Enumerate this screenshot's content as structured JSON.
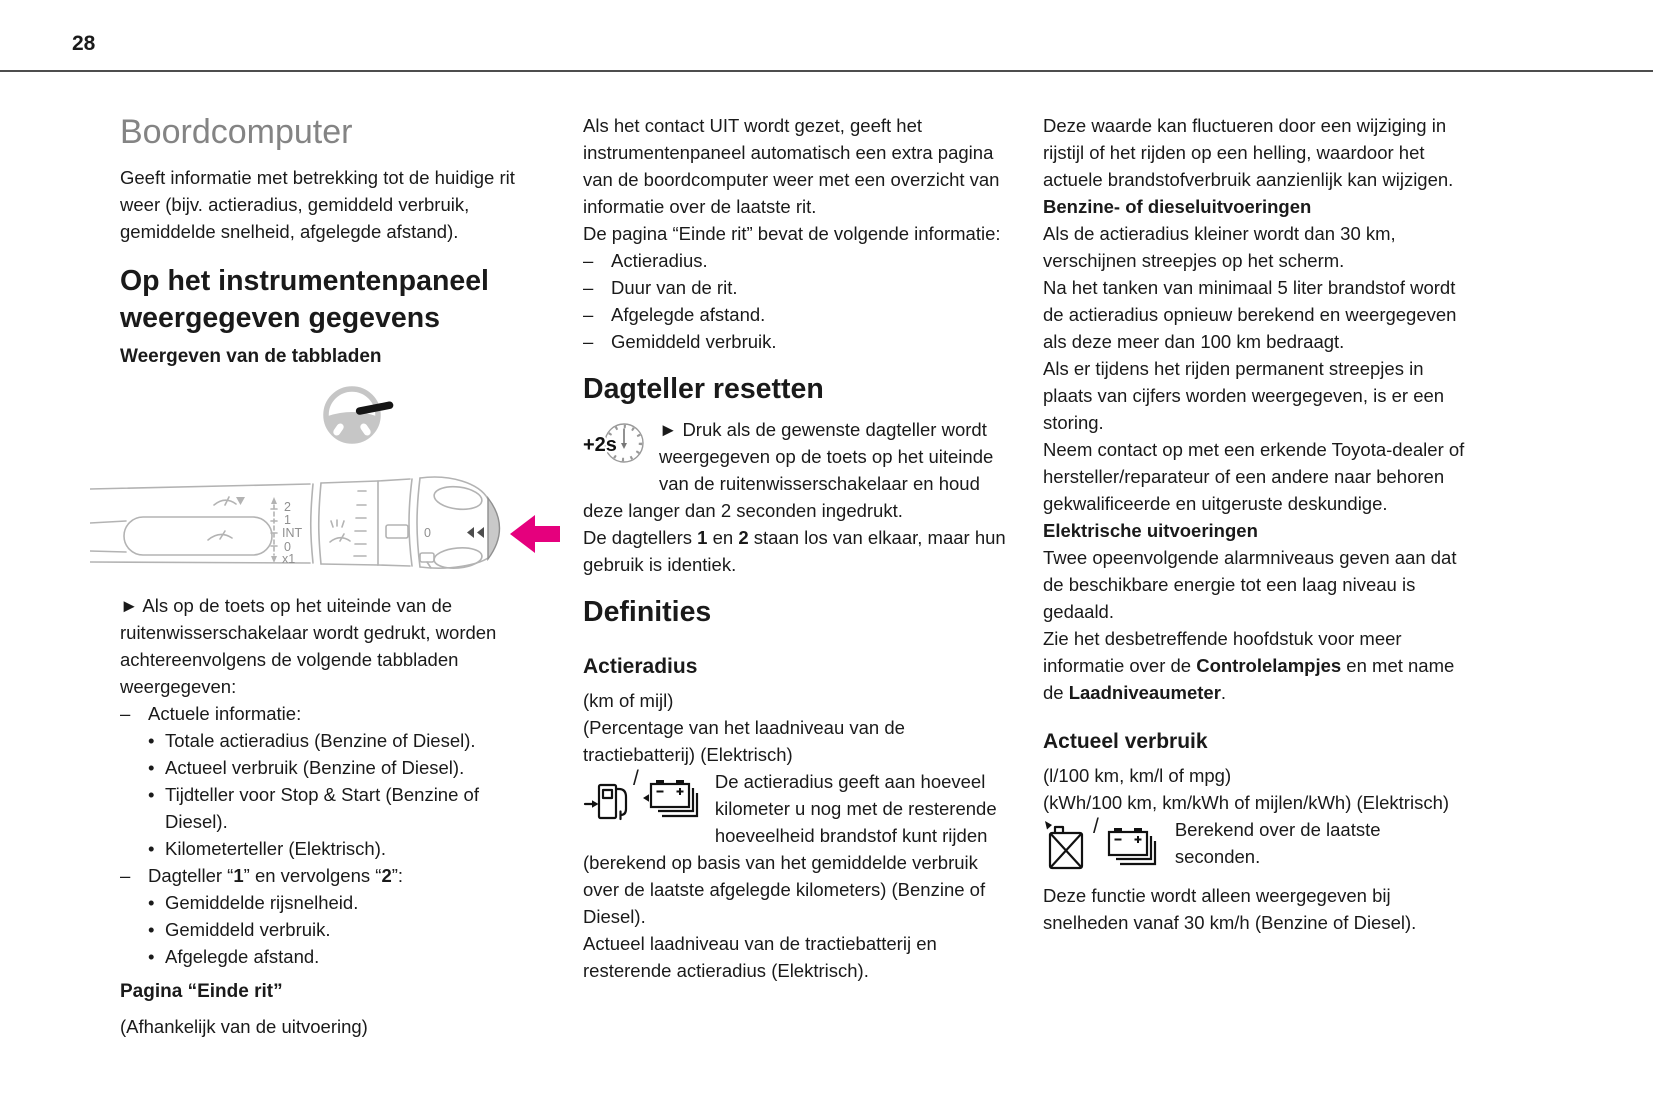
{
  "page": {
    "number": "28"
  },
  "colors": {
    "accent_arrow": "#e5007d",
    "title_gray": "#848484",
    "body_text": "#1a1a1a",
    "illustration_stroke": "#b3b3b3"
  },
  "col1": {
    "title": "Boordcomputer",
    "intro": "Geeft informatie met betrekking tot de huidige rit weer (bijv. actieradius, gemiddeld verbruik, gemiddelde snelheid, afgelegde afstand).",
    "h2": "Op het instrumentenpaneel weergegeven gegevens",
    "h3": "Weergeven van de tabbladen",
    "stalk_labels": {
      "speed2": "2",
      "speed1": "1",
      "int": "INT",
      "off": "0",
      "x1": "x1",
      "ring_zero": "0"
    },
    "arrow_note": "► Als op de toets op het uiteinde van de ruitenwisserschakelaar wordt gedrukt, worden achtereenvolgens de volgende tabbladen weergegeven:",
    "list": {
      "dash": "–",
      "bullet": "•",
      "item1": "Actuele informatie:",
      "sub1": [
        "Totale actieradius (Benzine of Diesel).",
        "Actueel verbruik (Benzine of Diesel).",
        "Tijdteller voor Stop & Start (Benzine of Diesel).",
        "Kilometerteller (Elektrisch)."
      ],
      "item2": {
        "a": "Dagteller “",
        "b": "1",
        "c": "” en vervolgens “",
        "d": "2",
        "e": "”:"
      },
      "sub2": [
        "Gemiddelde rijsnelheid.",
        "Gemiddeld verbruik.",
        "Afgelegde afstand."
      ]
    },
    "einde_rit_heading": "Pagina “Einde rit”",
    "einde_rit_note": "(Afhankelijk van de uitvoering)"
  },
  "col2": {
    "para1": "Als het contact UIT wordt gezet, geeft het instrumentenpaneel automatisch een extra pagina van de boordcomputer weer met een overzicht van informatie over de laatste rit.",
    "para2": "De pagina “Einde rit” bevat de volgende informatie:",
    "dash": "–",
    "dash_items": [
      "Actieradius.",
      "Duur van de rit.",
      "Afgelegde afstand.",
      "Gemiddeld verbruik."
    ],
    "h2_reset": "Dagteller resetten",
    "plus2s": "+2s",
    "reset_instruction": "► Druk als de gewenste dagteller wordt weergegeven op de toets op het uiteinde van de ruitenwisserschakelaar en houd deze langer dan 2 seconden ingedrukt.",
    "reset_note": {
      "a": "De dagtellers ",
      "b": "1",
      "c": " en ",
      "d": "2",
      "e": " staan los van elkaar, maar hun gebruik is identiek."
    },
    "h2_definities": "Definities",
    "h3_actieradius": "Actieradius",
    "unit1": "(km of mijl)",
    "unit2": "(Percentage van het laadniveau van de tractiebatterij) (Elektrisch)",
    "icon_separator": "/",
    "actieradius_text": "De actieradius geeft aan hoeveel kilometer u nog met de resterende hoeveelheid brandstof kunt rijden (berekend op basis van het gemiddelde verbruik over de laatste afgelegde kilometers) (Benzine of Diesel).",
    "actieradius_text2": "Actueel laadniveau van de tractiebatterij en resterende actieradius (Elektrisch)."
  },
  "col3": {
    "para1": "Deze waarde kan fluctueren door een wijziging in rijstijl of het rijden op een helling, waardoor het actuele brandstofverbruik aanzienlijk kan wijzigen.",
    "h4_benzine": "Benzine- of dieseluitvoeringen",
    "para2": "Als de actieradius kleiner wordt dan 30 km, verschijnen streepjes op het scherm.",
    "para3": "Na het tanken van minimaal 5 liter brandstof wordt de actieradius opnieuw berekend en weergegeven als deze meer dan 100 km bedraagt.",
    "para4": "Als er tijdens het rijden permanent streepjes in plaats van cijfers worden weergegeven, is er een storing.",
    "para5": "Neem contact op met een erkende Toyota-dealer of hersteller/reparateur of een andere naar behoren gekwalificeerde en uitgeruste deskundige.",
    "h4_elektrisch": "Elektrische uitvoeringen",
    "para6": "Twee opeenvolgende alarmniveaus geven aan dat de beschikbare energie tot een laag niveau is gedaald.",
    "para7": {
      "a": "Zie het desbetreffende hoofdstuk voor meer informatie over de ",
      "b": "Controlelampjes",
      "c": " en met name de ",
      "d": "Laadniveaumeter",
      "e": "."
    },
    "h3_verbruik": "Actueel verbruik",
    "unit1": "(l/100 km, km/l of mpg)",
    "unit2": "(kWh/100 km, km/kWh of mijlen/kWh) (Elektrisch)",
    "icon_separator": "/",
    "berekend": "Berekend over de laatste seconden.",
    "para8": "Deze functie wordt alleen weergegeven bij snelheden vanaf 30 km/h (Benzine of Diesel)."
  }
}
